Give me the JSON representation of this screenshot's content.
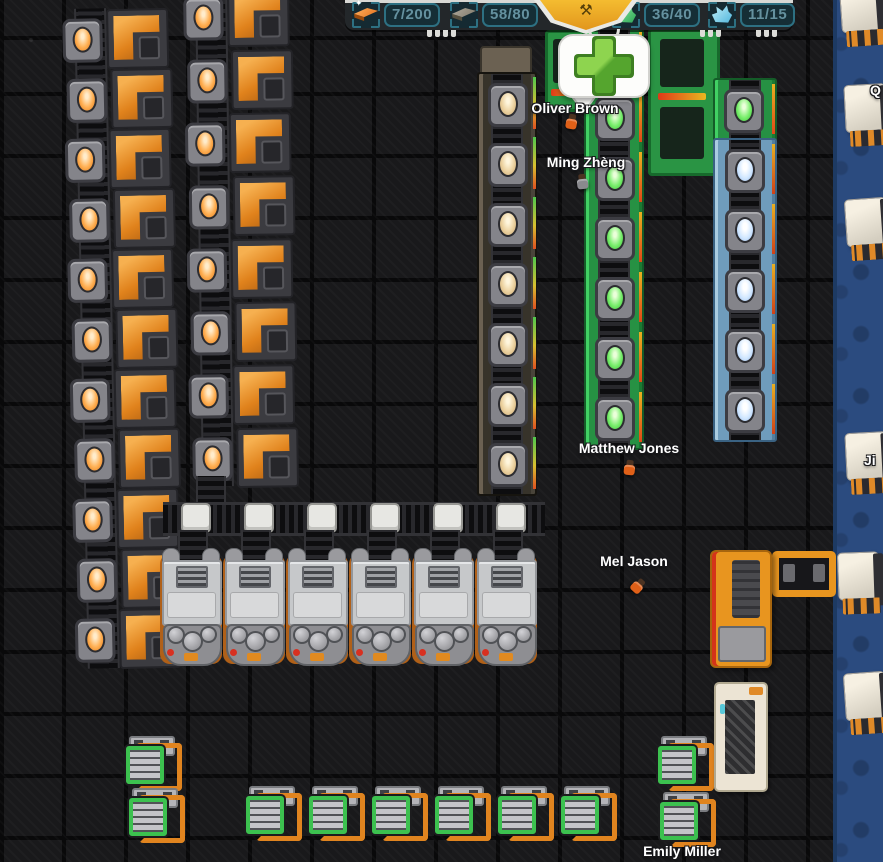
{
  "hud": {
    "resources": [
      {
        "icon": "copper-ingot-icon",
        "label": "7/200",
        "color": "#e8712a"
      },
      {
        "icon": "iron-ingot-icon",
        "label": "58/80",
        "color": "#8d867a"
      },
      {
        "icon": "green-goods-icon",
        "label": "36/40",
        "color": "#3ec46c"
      },
      {
        "icon": "blue-goods-icon",
        "label": "11/15",
        "color": "#7fd8ef"
      }
    ],
    "badge_icon": "mining-emblem-icon",
    "badge_glyph": "⚒"
  },
  "notification": {
    "icon": "add-plus-icon",
    "color": "#64b832"
  },
  "workers": [
    {
      "name": "Oliver Brown"
    },
    {
      "name": "Ming Zhèng"
    },
    {
      "name": "Matthew Jones"
    },
    {
      "name": "Mel Jason"
    },
    {
      "name": "Emily Miller"
    },
    {
      "name": "Q"
    },
    {
      "name": "Ji"
    }
  ],
  "colors": {
    "accent_orange": "#e8821f",
    "machine_green": "#2fae4e",
    "machine_blue": "#7fb2d8",
    "glow_amber": "#ffb054",
    "road_blue": "#2b4b7f",
    "hud_teal_border": "#2d7082",
    "hud_text": "#64919f",
    "plus_green": "#64b832"
  }
}
